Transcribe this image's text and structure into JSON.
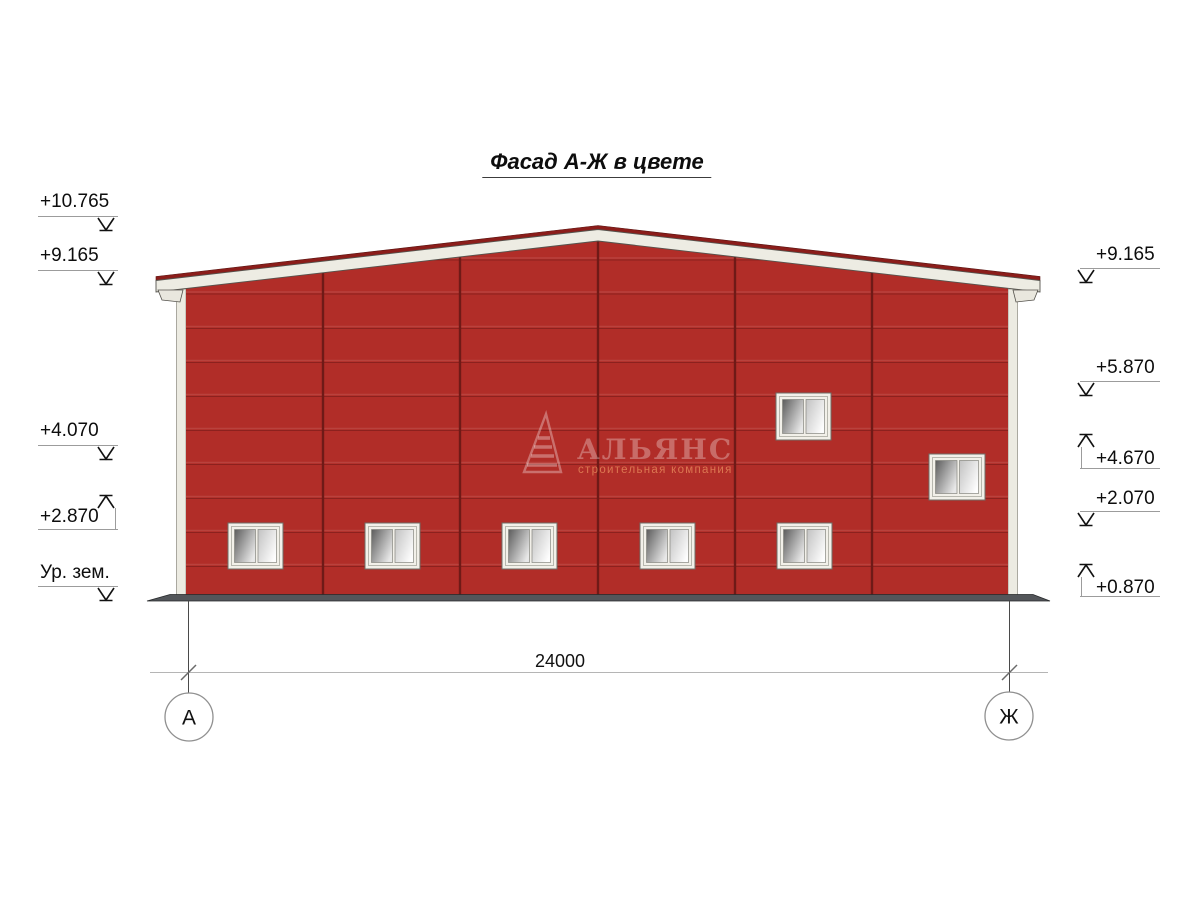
{
  "title": "Фасад А-Ж в цвете",
  "marks_left": [
    {
      "label": "+10.765",
      "dir": "down"
    },
    {
      "label": "+9.165",
      "dir": "down"
    },
    {
      "label": "+4.070",
      "dir": "down"
    },
    {
      "label": "+2.870",
      "dir": "up"
    },
    {
      "label": "Ур. зем.",
      "dir": "down"
    }
  ],
  "marks_right": [
    {
      "label": "+9.165",
      "dir": "down"
    },
    {
      "label": "+5.870",
      "dir": "down"
    },
    {
      "label": "+4.670",
      "dir": "up"
    },
    {
      "label": "+2.070",
      "dir": "down"
    },
    {
      "label": "+0.870",
      "dir": "up"
    }
  ],
  "dimension": {
    "total": "24000"
  },
  "axes": {
    "left": "А",
    "right": "Ж"
  },
  "watermark": {
    "name": "АЛЬЯНС",
    "tagline": "строительная компания"
  },
  "colors": {
    "wall": "#b12d28",
    "panel_line": "#8c211e",
    "joint_line": "#6f1a17",
    "fascia": "#edece3",
    "roof_edge": "#8b1d1a",
    "ground": "#53565a"
  }
}
